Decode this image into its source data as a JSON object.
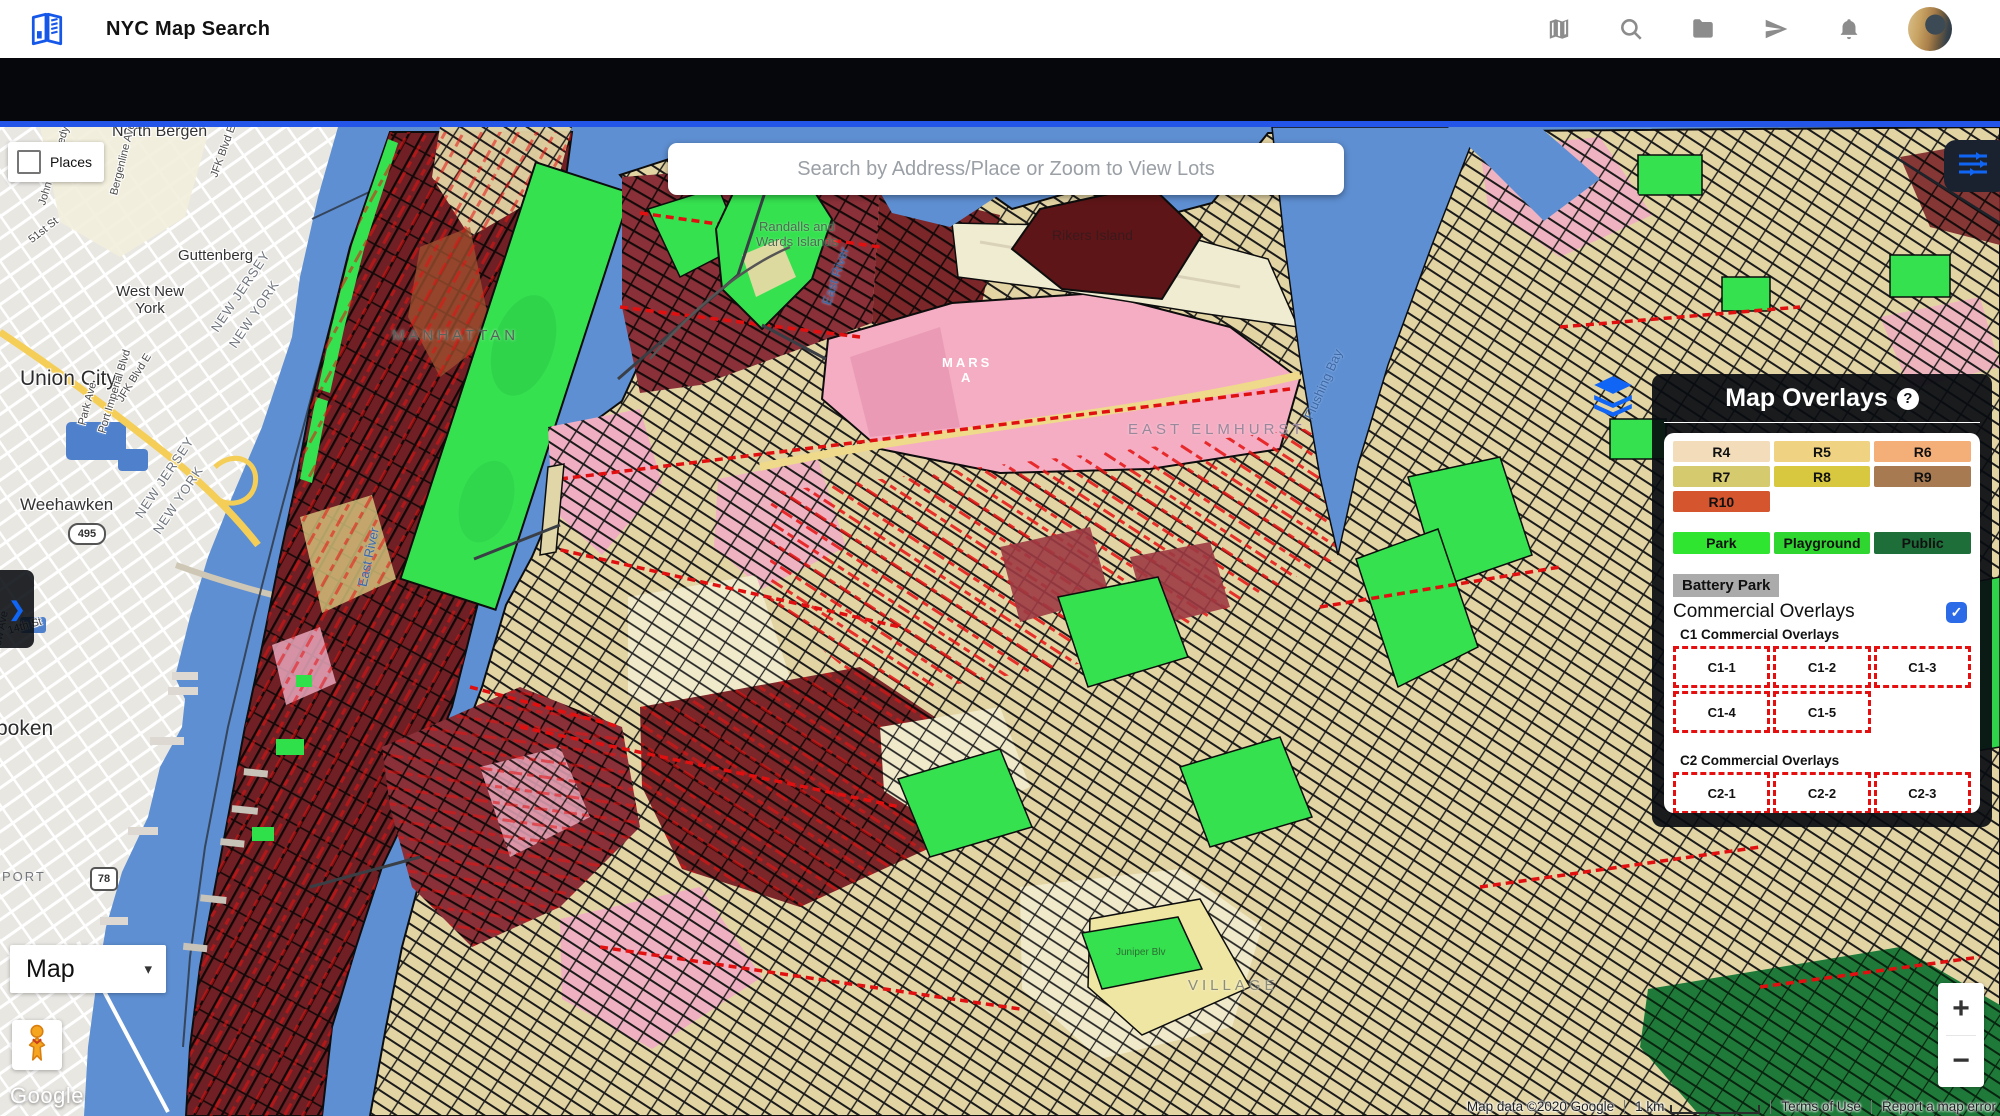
{
  "app": {
    "title": "NYC Map Search"
  },
  "header": {
    "icons": [
      "map-icon",
      "search-icon",
      "folder-icon",
      "send-icon",
      "bell-icon",
      "avatar"
    ]
  },
  "search": {
    "placeholder": "Search by Address/Place or Zoom to View Lots"
  },
  "places": {
    "label": "Places",
    "checked": false
  },
  "map_type": {
    "label": "Map",
    "caret": "▾"
  },
  "zoom_control": {
    "in": "+",
    "out": "−"
  },
  "left_tab": {
    "chevron": "❯"
  },
  "google_logo": "Google",
  "attribution": {
    "map_data": "Map data ©2020 Google",
    "scale": "1 km",
    "terms": "Terms of Use",
    "report": "Report a map error"
  },
  "colors": {
    "accent_blue": "#1065F5",
    "top_border_blue": "#2355E8",
    "panel_bg": "#0B0E13",
    "water": "#5E8FD2"
  },
  "overlays_panel": {
    "title": "Map Overlays",
    "help": "?",
    "residential": [
      {
        "label": "R4",
        "color": "#F2DCBA"
      },
      {
        "label": "R5",
        "color": "#EFD382"
      },
      {
        "label": "R6",
        "color": "#F4AF79"
      },
      {
        "label": "R7",
        "color": "#D5CA6E"
      },
      {
        "label": "R8",
        "color": "#D7C83F"
      },
      {
        "label": "R9",
        "color": "#A87A52"
      },
      {
        "label": "R10",
        "color": "#D5552F"
      }
    ],
    "parks": [
      {
        "label": "Park",
        "color": "#2FE52F"
      },
      {
        "label": "Playground",
        "color": "#2FD62F"
      },
      {
        "label": "Public",
        "color": "#1D6E38"
      }
    ],
    "battery_park": "Battery Park",
    "commercial_toggle": {
      "label": "Commercial Overlays",
      "checked": true,
      "check": "✓",
      "color": "#2B6BE8"
    },
    "c1": {
      "heading": "C1 Commercial Overlays",
      "items": [
        "C1-1",
        "C1-2",
        "C1-3",
        "C1-4",
        "C1-5"
      ]
    },
    "c2": {
      "heading": "C2 Commercial Overlays",
      "items": [
        "C2-1",
        "C2-2",
        "C2-3"
      ]
    },
    "chip_border_color": "#E60F0F"
  },
  "map_labels": {
    "items": [
      {
        "text": "North Bergen",
        "x": 112,
        "y": -4,
        "rot": 0,
        "cls": "loc lg"
      },
      {
        "text": "Guttenberg",
        "x": 178,
        "y": 120,
        "rot": 0,
        "cls": "loc"
      },
      {
        "text": "West New\nYork",
        "x": 116,
        "y": 156,
        "rot": 0,
        "cls": "loc center"
      },
      {
        "text": "Union City",
        "x": 20,
        "y": 240,
        "rot": 0,
        "cls": "loc xl"
      },
      {
        "text": "Weehawken",
        "x": 20,
        "y": 368,
        "rot": 0,
        "cls": "loc lg2"
      },
      {
        "text": "495",
        "x": 68,
        "y": 396,
        "rot": 0,
        "cls": "shield oval"
      },
      {
        "text": "boken",
        "x": -4,
        "y": 590,
        "rot": 0,
        "cls": "loc xl"
      },
      {
        "text": "PORT",
        "x": 2,
        "y": 742,
        "rot": 0,
        "cls": "areacaps dim"
      },
      {
        "text": "78",
        "x": 90,
        "y": 740,
        "rot": 0,
        "cls": "shield sqs"
      },
      {
        "text": "West Side Ave",
        "x": -30,
        "y": 96,
        "rot": -75,
        "cls": "street"
      },
      {
        "text": "51st St",
        "x": 30,
        "y": 108,
        "rot": -38,
        "cls": "street"
      },
      {
        "text": "John F. Kennedy Blvd",
        "x": 42,
        "y": 72,
        "rot": -73,
        "cls": "street"
      },
      {
        "text": "Bergenline Ave",
        "x": 114,
        "y": 62,
        "rot": -76,
        "cls": "street"
      },
      {
        "text": "JFK Blvd E",
        "x": 214,
        "y": 44,
        "rot": -70,
        "cls": "street"
      },
      {
        "text": "JFK Blvd E",
        "x": 120,
        "y": 268,
        "rot": -58,
        "cls": "street"
      },
      {
        "text": "Port Imperial Blvd",
        "x": 102,
        "y": 300,
        "rot": -73,
        "cls": "street"
      },
      {
        "text": "Park Ave",
        "x": 82,
        "y": 292,
        "rot": -75,
        "cls": "street"
      },
      {
        "text": "Willow Ave",
        "x": -6,
        "y": 530,
        "rot": -78,
        "cls": "street"
      },
      {
        "text": "14th St",
        "x": 8,
        "y": 498,
        "rot": -16,
        "cls": "street"
      },
      {
        "text": "NEW JERSEY",
        "x": 214,
        "y": 196,
        "rot": -56,
        "cls": "boundary"
      },
      {
        "text": "NEW YORK",
        "x": 232,
        "y": 212,
        "rot": -56,
        "cls": "boundary"
      },
      {
        "text": "NEW JERSEY",
        "x": 138,
        "y": 382,
        "rot": -56,
        "cls": "boundary"
      },
      {
        "text": "NEW YORK",
        "x": 156,
        "y": 398,
        "rot": -56,
        "cls": "boundary"
      },
      {
        "text": "MANHATTAN",
        "x": 392,
        "y": 200,
        "rot": 0,
        "cls": "areacaps"
      },
      {
        "text": "Randalls and\nWards Islands",
        "x": 756,
        "y": 92,
        "rot": 0,
        "cls": "area center"
      },
      {
        "text": "East River",
        "x": 826,
        "y": 170,
        "rot": -72,
        "cls": "water"
      },
      {
        "text": "East River",
        "x": 362,
        "y": 452,
        "rot": -78,
        "cls": "water"
      },
      {
        "text": "Rikers Island",
        "x": 1052,
        "y": 100,
        "rot": 0,
        "cls": "area darkbg"
      },
      {
        "text": "EAST ELMHURST",
        "x": 1128,
        "y": 294,
        "rot": 0,
        "cls": "areacaps pinkbg"
      },
      {
        "text": "Flushing Bay",
        "x": 1308,
        "y": 284,
        "rot": -66,
        "cls": "water"
      },
      {
        "text": "MARS\nA",
        "x": 942,
        "y": 228,
        "rot": 0,
        "cls": "whitecaps center"
      },
      {
        "text": "VILLAGE",
        "x": 1188,
        "y": 850,
        "rot": 0,
        "cls": "areacaps dim2"
      },
      {
        "text": "Juniper Blv",
        "x": 1116,
        "y": 820,
        "rot": 0,
        "cls": "street green"
      }
    ]
  }
}
